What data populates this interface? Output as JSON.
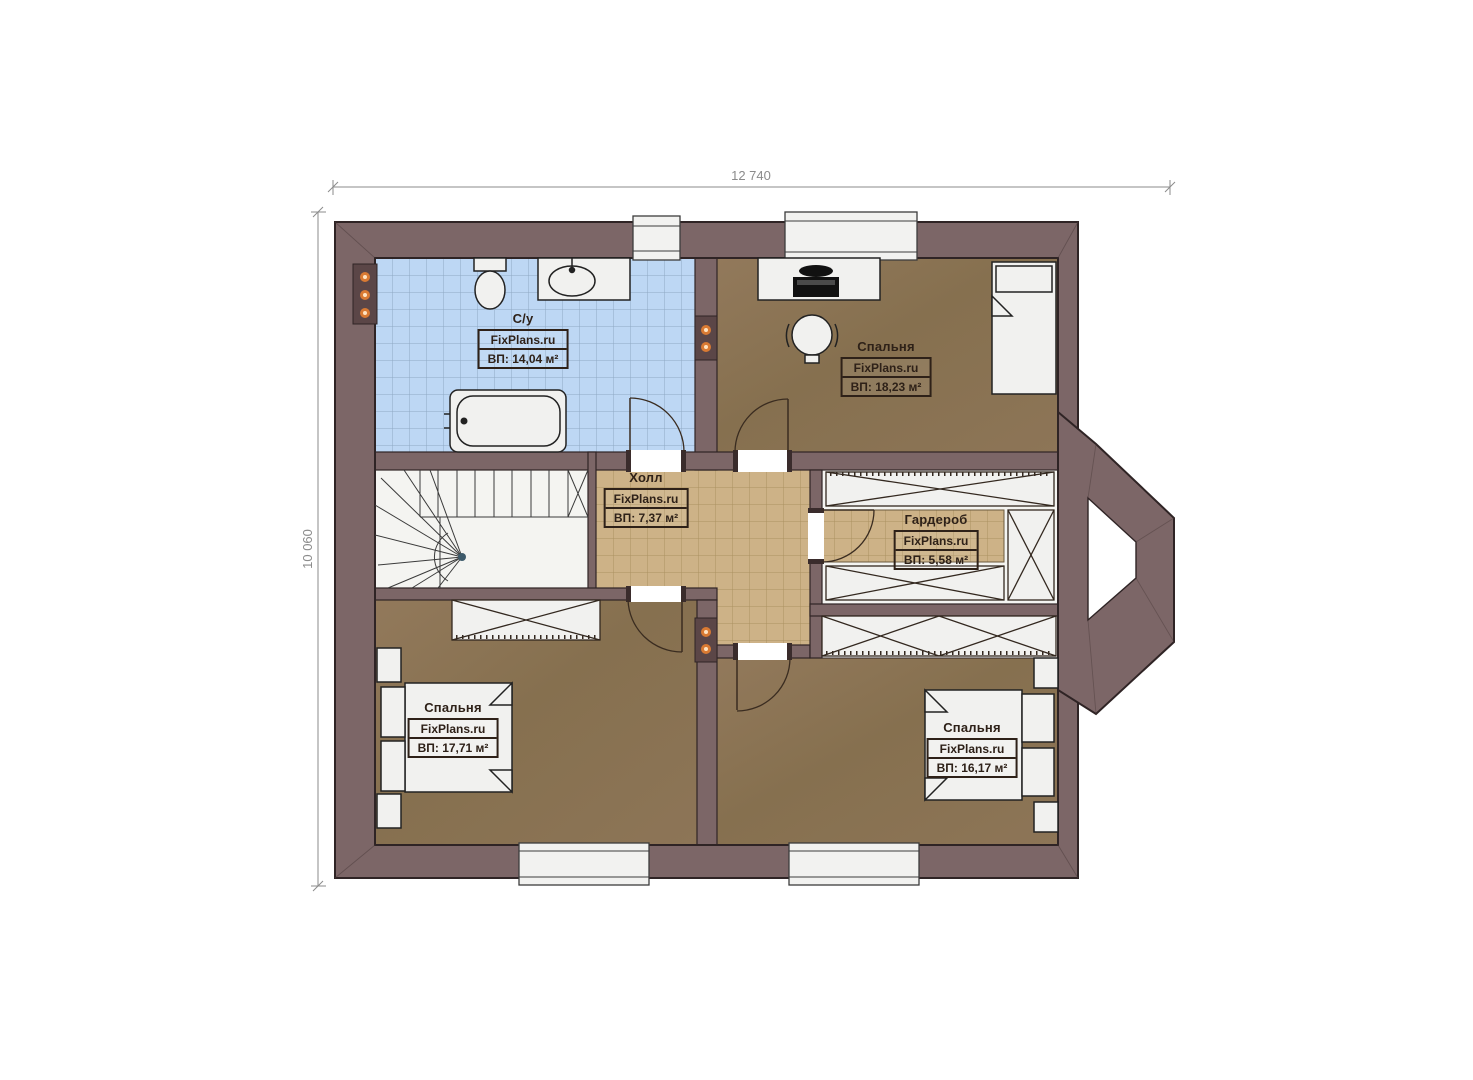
{
  "plan": {
    "type": "floor-plan",
    "brand_watermark": "FixPlans.ru",
    "dimensions": {
      "horizontal": "12 740",
      "vertical": "10 060"
    },
    "rooms": [
      {
        "id": "bathroom",
        "name": "С/у",
        "brand": "FixPlans.ru",
        "area": "ВП: 14,04 м²"
      },
      {
        "id": "bedroom-top-right",
        "name": "Спальня",
        "brand": "FixPlans.ru",
        "area": "ВП: 18,23 м²"
      },
      {
        "id": "hall",
        "name": "Холл",
        "brand": "FixPlans.ru",
        "area": "ВП: 7,37 м²"
      },
      {
        "id": "wardrobe",
        "name": "Гардероб",
        "brand": "FixPlans.ru",
        "area": "ВП: 5,58 м²"
      },
      {
        "id": "bedroom-bottom-left",
        "name": "Спальня",
        "brand": "FixPlans.ru",
        "area": "ВП: 17,71 м²"
      },
      {
        "id": "bedroom-bottom-right",
        "name": "Спальня",
        "brand": "FixPlans.ru",
        "area": "ВП: 16,17 м²"
      }
    ],
    "colors": {
      "wall": "#7c6667",
      "wall_outline": "#2f2425",
      "floor_wood": "#8c7457",
      "tile_bathroom": "#bdd7f4",
      "tile_hall": "#cdb287",
      "fixture_white": "#f1f1ef",
      "sconce_accent": "#e07a35",
      "dimension_text": "#8b8b8b"
    }
  }
}
